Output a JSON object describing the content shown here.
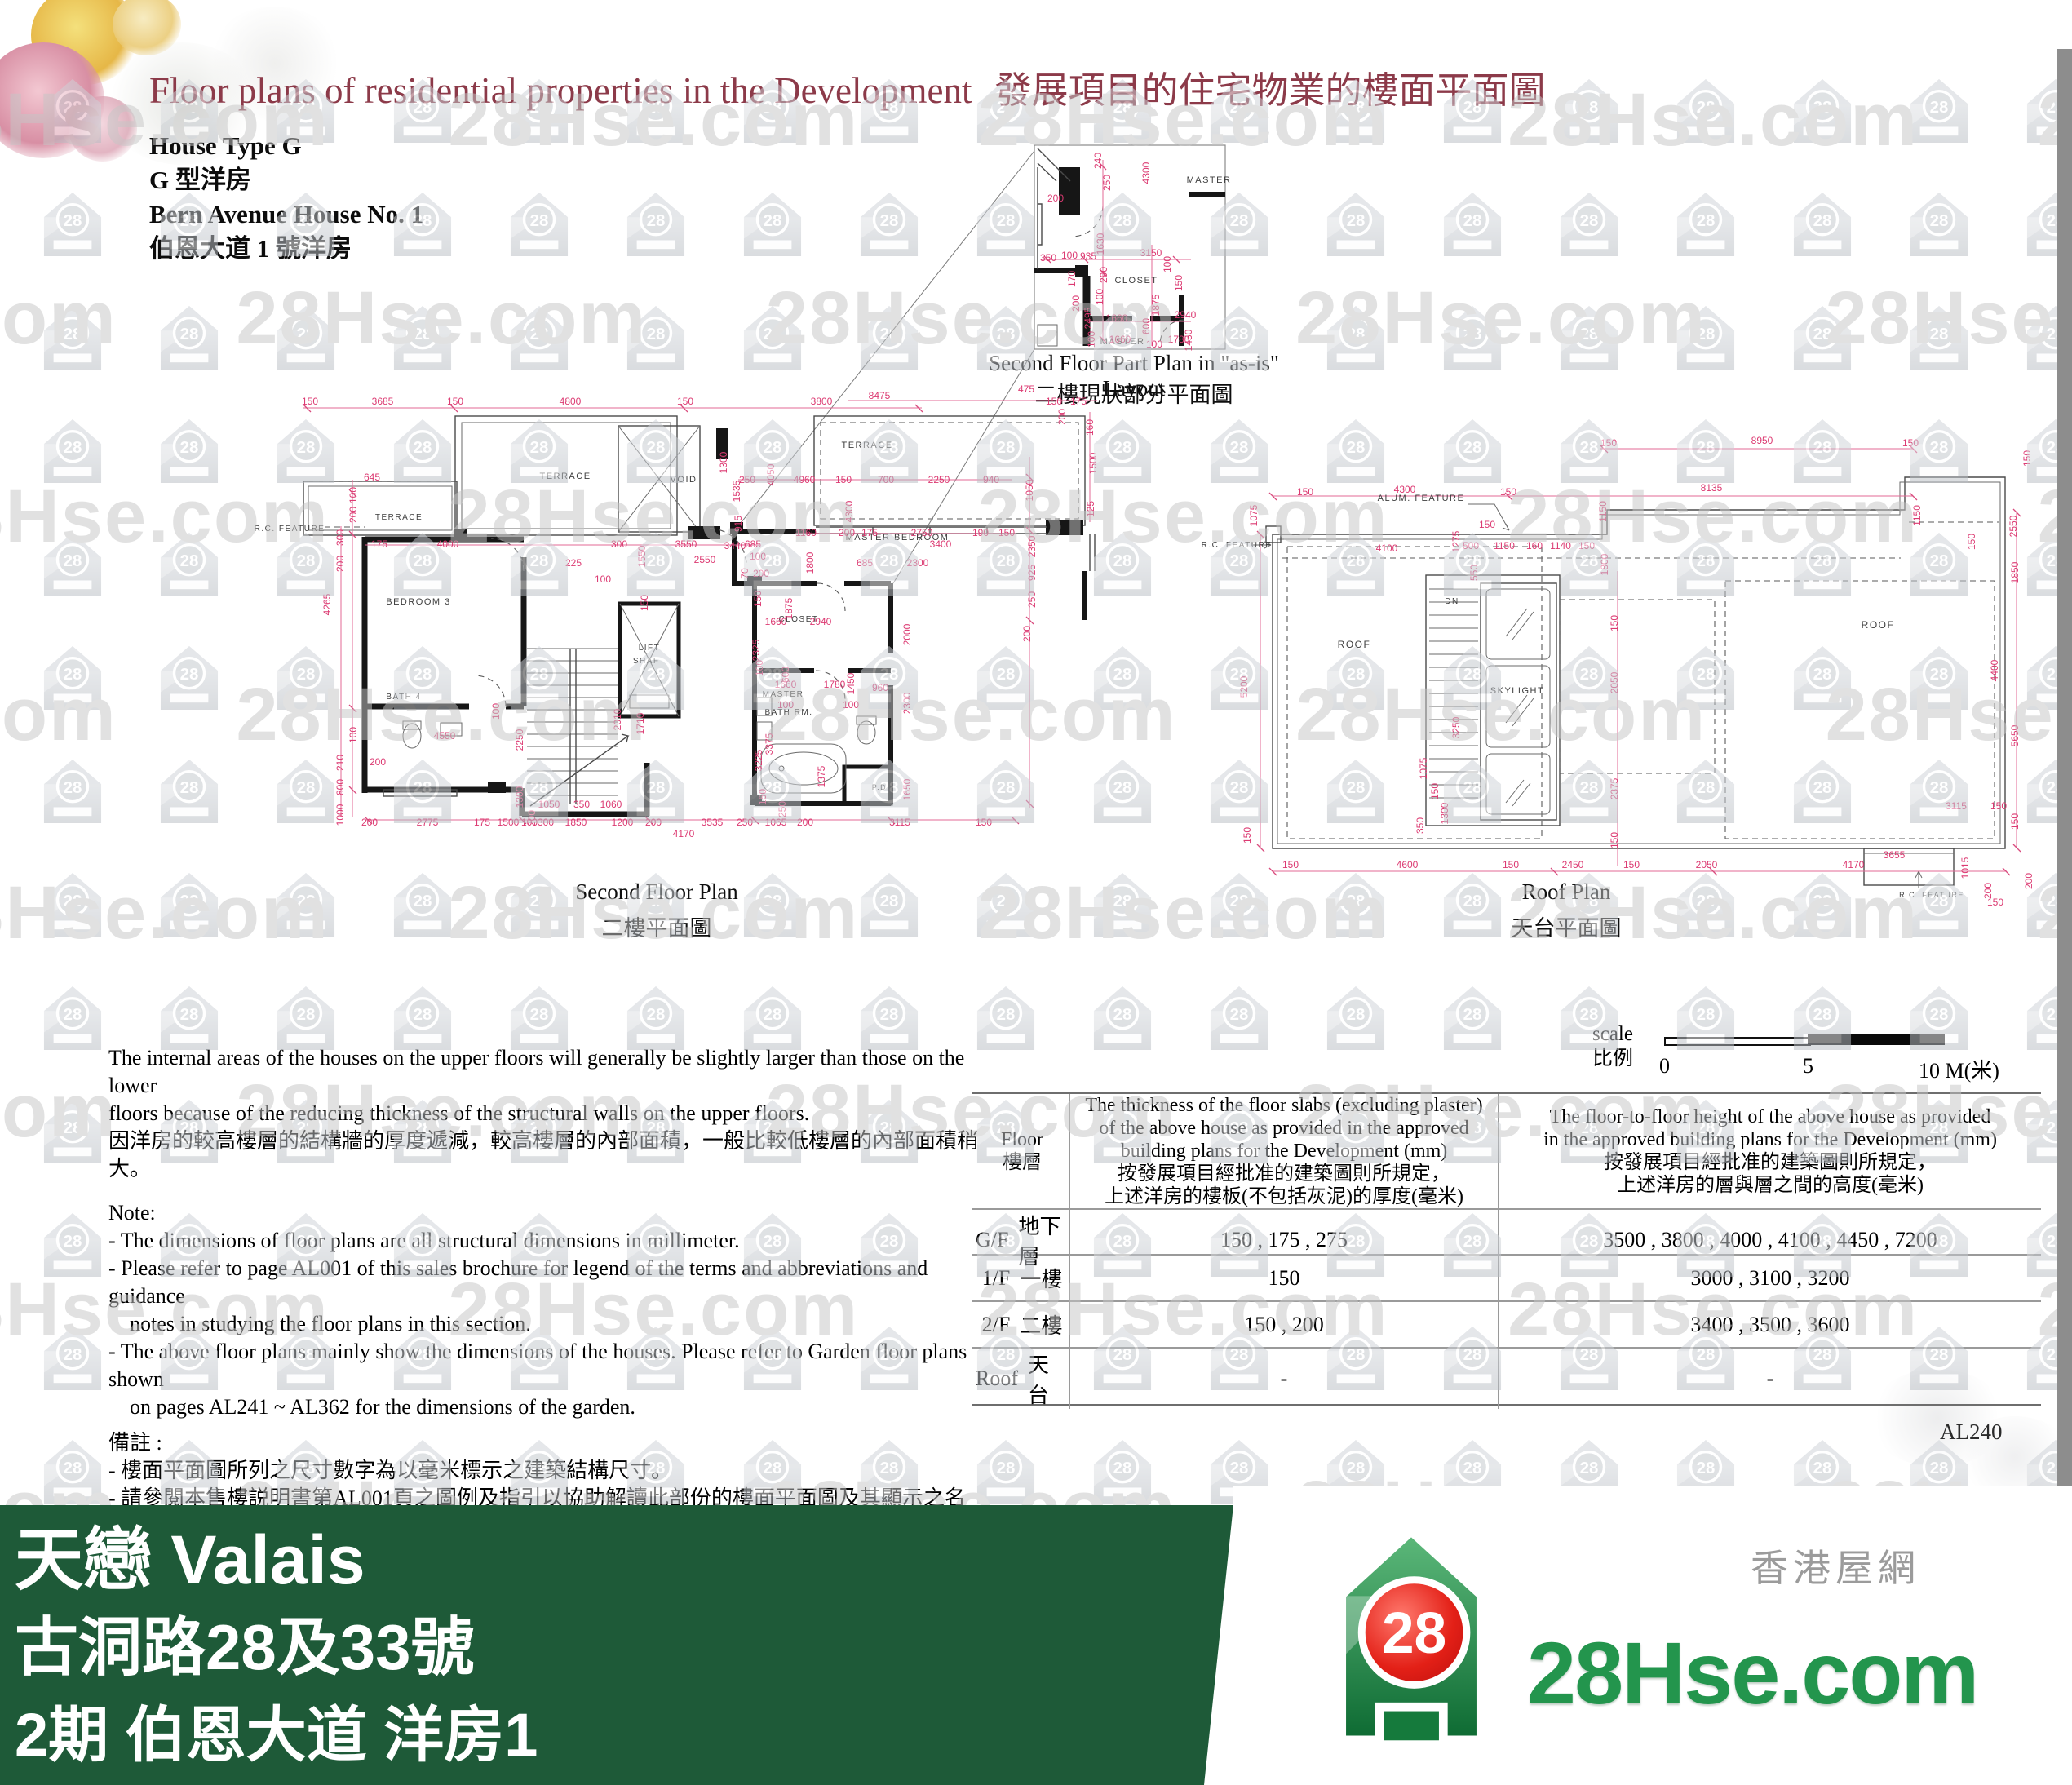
{
  "header": {
    "title_en": "Floor plans of residential properties in the Development",
    "title_zh": "發展項目的住宅物業的樓面平面圖",
    "house_type_en": "House Type G",
    "house_type_zh": "G 型洋房",
    "house_name_en": "Bern Avenue House No. 1",
    "house_name_zh": "伯恩大道 1 號洋房"
  },
  "watermark": {
    "text": "28Hse.com",
    "icon_label": "28"
  },
  "plans": {
    "inset": {
      "caption_en": "Second Floor Part Plan in \"as-is\" Layout",
      "caption_zh": "二樓現狀部分平面圖",
      "rooms": [
        [
          "MASTER",
          1482,
          224,
          11
        ],
        [
          "CLOSET",
          1393,
          347,
          11
        ],
        [
          "MASTER",
          1376,
          422,
          11
        ]
      ],
      "dims": [
        [
          "240",
          1350,
          197,
          1
        ],
        [
          "250",
          1361,
          224,
          1
        ],
        [
          "4300",
          1409,
          212,
          1
        ],
        [
          "200",
          1294,
          247
        ],
        [
          "350",
          1285,
          320
        ],
        [
          "100",
          1311,
          317
        ],
        [
          "935",
          1334,
          318
        ],
        [
          "1630",
          1353,
          299,
          1
        ],
        [
          "3150",
          1411,
          314
        ],
        [
          "100",
          1435,
          324,
          1
        ],
        [
          "150",
          1449,
          347,
          1
        ],
        [
          "170",
          1318,
          342,
          1
        ],
        [
          "290",
          1357,
          337,
          1
        ],
        [
          "100",
          1352,
          364,
          1
        ],
        [
          "200",
          1323,
          372,
          1
        ],
        [
          "2495",
          1338,
          390,
          1
        ],
        [
          "1660",
          1369,
          394
        ],
        [
          "1875",
          1421,
          374,
          1
        ],
        [
          "2940",
          1453,
          390
        ],
        [
          "100",
          1342,
          416,
          1
        ],
        [
          "600",
          1409,
          400,
          1
        ],
        [
          "1660",
          1373,
          420
        ],
        [
          "100",
          1415,
          426
        ],
        [
          "1780",
          1445,
          420
        ],
        [
          "1450",
          1461,
          417,
          1
        ]
      ]
    },
    "second": {
      "caption_en": "Second Floor Plan",
      "caption_zh": "二樓平面圖",
      "rooms": [
        [
          "TERRACE",
          489,
          637,
          10
        ],
        [
          "TERRACE",
          693,
          587,
          11
        ],
        [
          "VOID",
          838,
          591,
          11
        ],
        [
          "TERRACE",
          1063,
          549,
          11
        ],
        [
          "MASTER BEDROOM",
          1100,
          662,
          11
        ],
        [
          "R.C. FEATURE",
          355,
          651,
          10
        ],
        [
          "BEDROOM 3",
          513,
          741,
          11
        ],
        [
          "LIFT",
          796,
          797,
          10
        ],
        [
          "SHAFT",
          796,
          813,
          10
        ],
        [
          "BATH 4",
          495,
          857,
          10
        ],
        [
          "CLOSET",
          979,
          762,
          10
        ],
        [
          "MASTER",
          960,
          854,
          10
        ],
        [
          "BATH RM.",
          967,
          876,
          10
        ],
        [
          "P.D.",
          1080,
          968,
          9
        ]
      ],
      "dims": [
        [
          "150",
          380,
          496
        ],
        [
          "3685",
          469,
          496
        ],
        [
          "150",
          558,
          496
        ],
        [
          "4800",
          699,
          496
        ],
        [
          "150",
          840,
          496
        ],
        [
          "3800",
          1007,
          496
        ],
        [
          "8475",
          1078,
          489
        ],
        [
          "475",
          1258,
          481
        ],
        [
          "150",
          1292,
          496
        ],
        [
          "175",
          1322,
          496
        ],
        [
          "160",
          1340,
          524,
          1
        ],
        [
          "200",
          1306,
          511,
          1
        ],
        [
          "1500",
          1344,
          568,
          1
        ],
        [
          "125",
          1341,
          624,
          1
        ],
        [
          "1050",
          1266,
          601,
          1
        ],
        [
          "2350",
          1269,
          670,
          1
        ],
        [
          "925",
          1269,
          702,
          1
        ],
        [
          "250",
          1269,
          735,
          1
        ],
        [
          "200",
          1263,
          777,
          1
        ],
        [
          "2000",
          1116,
          778,
          1
        ],
        [
          "2300",
          1116,
          862,
          1
        ],
        [
          "1650",
          1116,
          968,
          1
        ],
        [
          "250",
          916,
          592
        ],
        [
          "4960",
          986,
          592
        ],
        [
          "150",
          1034,
          592
        ],
        [
          "700",
          1086,
          592
        ],
        [
          "2250",
          1151,
          592
        ],
        [
          "940",
          1215,
          592
        ],
        [
          "4050",
          949,
          582,
          1
        ],
        [
          "1535",
          907,
          602,
          1
        ],
        [
          "915",
          909,
          642,
          1
        ],
        [
          "1300",
          891,
          567,
          1
        ],
        [
          "4300",
          1045,
          627,
          1
        ],
        [
          "645",
          456,
          589
        ],
        [
          "100",
          437,
          607,
          1
        ],
        [
          "200",
          437,
          631,
          1
        ],
        [
          "300",
          421,
          659,
          1
        ],
        [
          "200",
          421,
          691,
          1
        ],
        [
          "4265",
          405,
          741,
          1
        ],
        [
          "100",
          437,
          901,
          1
        ],
        [
          "210",
          421,
          935,
          1
        ],
        [
          "800",
          421,
          965,
          1
        ],
        [
          "1000",
          421,
          999,
          1
        ],
        [
          "175",
          465,
          671
        ],
        [
          "4000",
          549,
          671
        ],
        [
          "300",
          759,
          671
        ],
        [
          "3550",
          841,
          671
        ],
        [
          "685",
          923,
          671
        ],
        [
          "3400",
          1153,
          671
        ],
        [
          "1160",
          988,
          657
        ],
        [
          "200",
          1038,
          657
        ],
        [
          "175",
          1066,
          657
        ],
        [
          "2750",
          1130,
          657
        ],
        [
          "190",
          1202,
          657
        ],
        [
          "150",
          1234,
          657
        ],
        [
          "225",
          703,
          694
        ],
        [
          "100",
          739,
          714
        ],
        [
          "1550",
          791,
          682,
          1
        ],
        [
          "150",
          794,
          739,
          1
        ],
        [
          "2550",
          864,
          690
        ],
        [
          "200",
          933,
          707
        ],
        [
          "1800",
          997,
          690,
          1
        ],
        [
          "685",
          1060,
          694
        ],
        [
          "2300",
          1125,
          694
        ],
        [
          "4550",
          545,
          906
        ],
        [
          "200",
          463,
          938
        ],
        [
          "100",
          612,
          872,
          1
        ],
        [
          "2010",
          761,
          882,
          1
        ],
        [
          "1710",
          789,
          887,
          1
        ],
        [
          "2250",
          641,
          907,
          1
        ],
        [
          "1300",
          641,
          977,
          1
        ],
        [
          "200",
          656,
          1003,
          1
        ],
        [
          "1050",
          673,
          990
        ],
        [
          "350",
          713,
          990
        ],
        [
          "1060",
          749,
          990
        ],
        [
          "3440",
          901,
          673
        ],
        [
          "100",
          929,
          686
        ],
        [
          "70",
          917,
          703,
          1
        ],
        [
          "150",
          933,
          734,
          1
        ],
        [
          "1875",
          971,
          746,
          1
        ],
        [
          "1660",
          951,
          766
        ],
        [
          "2940",
          1006,
          766
        ],
        [
          "2325",
          931,
          797,
          1
        ],
        [
          "100",
          935,
          819,
          1
        ],
        [
          "600",
          967,
          827,
          1
        ],
        [
          "1660",
          963,
          843
        ],
        [
          "1780",
          1023,
          843
        ],
        [
          "1450",
          1047,
          838,
          1
        ],
        [
          "960",
          1079,
          847
        ],
        [
          "100",
          963,
          868
        ],
        [
          "100",
          1043,
          868
        ],
        [
          "3375",
          947,
          912,
          1
        ],
        [
          "3225",
          934,
          932,
          1
        ],
        [
          "1375",
          1011,
          952,
          1
        ],
        [
          "150",
          939,
          977,
          1
        ],
        [
          "250",
          963,
          992,
          1
        ],
        [
          "200",
          453,
          1012
        ],
        [
          "2775",
          524,
          1012
        ],
        [
          "175",
          591,
          1012
        ],
        [
          "1500",
          623,
          1012
        ],
        [
          "100",
          649,
          1012
        ],
        [
          "300",
          669,
          1012
        ],
        [
          "1850",
          706,
          1012
        ],
        [
          "1200",
          763,
          1012
        ],
        [
          "200",
          801,
          1012
        ],
        [
          "3535",
          873,
          1012
        ],
        [
          "250",
          913,
          1012
        ],
        [
          "1065",
          951,
          1012
        ],
        [
          "200",
          987,
          1012
        ],
        [
          "3115",
          1103,
          1012
        ],
        [
          "150",
          1206,
          1012
        ],
        [
          "4170",
          838,
          1026
        ]
      ]
    },
    "roof": {
      "caption_en": "Roof Plan",
      "caption_zh": "天台平面圖",
      "rooms": [
        [
          "ALUM. FEATURE",
          1742,
          614,
          11
        ],
        [
          "R.C. FEATURE",
          1516,
          671,
          10
        ],
        [
          "ROOF",
          1660,
          794,
          12
        ],
        [
          "DN",
          1780,
          740,
          10
        ],
        [
          "SKYLIGHT",
          1860,
          850,
          11
        ],
        [
          "ROOF",
          2302,
          770,
          12
        ],
        [
          "R.C. FEATURE",
          2368,
          1100,
          9
        ]
      ],
      "dims": [
        [
          "150",
          1972,
          547
        ],
        [
          "8950",
          2160,
          544
        ],
        [
          "150",
          2342,
          547
        ],
        [
          "150",
          1600,
          607
        ],
        [
          "4300",
          1722,
          604
        ],
        [
          "150",
          1849,
          607
        ],
        [
          "8135",
          2098,
          602
        ],
        [
          "1150",
          2354,
          632,
          1
        ],
        [
          "2550",
          2472,
          645,
          1
        ],
        [
          "150",
          2489,
          562,
          1
        ],
        [
          "1075",
          1541,
          632,
          1
        ],
        [
          "5200",
          1529,
          842,
          1
        ],
        [
          "150",
          1533,
          1024,
          1
        ],
        [
          "4100",
          1700,
          676
        ],
        [
          "1275",
          1789,
          664,
          1
        ],
        [
          "550",
          1811,
          702,
          1
        ],
        [
          "150",
          1823,
          647
        ],
        [
          "500",
          1803,
          673
        ],
        [
          "1150",
          1844,
          673
        ],
        [
          "160",
          1881,
          673
        ],
        [
          "1140",
          1913,
          673
        ],
        [
          "150",
          1945,
          673
        ],
        [
          "1800",
          1971,
          692,
          1
        ],
        [
          "1150",
          1969,
          627,
          1
        ],
        [
          "150",
          2421,
          664,
          1
        ],
        [
          "4400",
          2449,
          822,
          1
        ],
        [
          "1850",
          2474,
          702,
          1
        ],
        [
          "5650",
          2474,
          902,
          1
        ],
        [
          "150",
          2474,
          1007,
          1
        ],
        [
          "200",
          2491,
          1080,
          1
        ],
        [
          "150",
          2446,
          1110
        ],
        [
          "3250",
          1789,
          892,
          1
        ],
        [
          "2050",
          1983,
          837,
          1
        ],
        [
          "150",
          1983,
          764,
          1
        ],
        [
          "2375",
          1983,
          967,
          1
        ],
        [
          "150",
          1983,
          1030,
          1
        ],
        [
          "1075",
          1749,
          942,
          1
        ],
        [
          "150",
          1763,
          970,
          1
        ],
        [
          "1300",
          1775,
          997,
          1
        ],
        [
          "350",
          1745,
          1012,
          1
        ],
        [
          "150",
          1582,
          1064
        ],
        [
          "4600",
          1725,
          1064
        ],
        [
          "150",
          1852,
          1064
        ],
        [
          "2450",
          1928,
          1064
        ],
        [
          "150",
          2000,
          1064
        ],
        [
          "2050",
          2092,
          1064
        ],
        [
          "4170",
          2272,
          1064
        ],
        [
          "3655",
          2322,
          1052
        ],
        [
          "1015",
          2413,
          1064,
          1
        ],
        [
          "200",
          2441,
          1092,
          1
        ],
        [
          "3115",
          2398,
          992
        ],
        [
          "150",
          2450,
          992
        ]
      ]
    }
  },
  "notes": {
    "en1": "The internal areas of the houses on the upper floors will generally be slightly larger than those on the lower",
    "en2": "floors because of the reducing thickness of the structural walls on the upper floors.",
    "zh": "因洋房的較高樓層的結構牆的厚度遞減，較高樓層的內部面積，一般比較低樓層的內部面積稍大。",
    "note_label": "Note:",
    "n1": "- The dimensions of floor plans are all structural dimensions in millimeter.",
    "n2a": "- Please refer to page AL001 of this sales brochure for legend of the terms and abbreviations and guidance",
    "n2b": "notes in studying the floor plans in this section.",
    "n3a": "- The above floor plans mainly show the dimensions of the houses. Please refer to Garden floor plans shown",
    "n3b": "on pages AL241 ~ AL362 for the dimensions of the garden.",
    "zh_label": "備註 :",
    "zn1": "- 樓面平面圖所列之尺寸數字為以毫米標示之建築結構尺寸。",
    "zn2": "- 請參閱本售樓説明書第AL001頁之圖例及指引以協助解讀此部份的樓面平面圖及其顯示之名稱及簡稱。",
    "zn3": "- 以上樓面平面圖主要顯示洋房的呎吋，有關花園的呎吋，請參閱第AL241頁至AL362頁的花園平面圖。"
  },
  "scale": {
    "label_en": "scale",
    "label_zh": "比例",
    "tick0": "0",
    "tick5": "5",
    "tick10": "10 M(米)"
  },
  "table": {
    "col1_en": "Floor",
    "col1_zh": "樓層",
    "col2_en1": "The thickness of the floor slabs (excluding plaster)",
    "col2_en2": "of the above house as provided in the approved",
    "col2_en3": "building plans for the Development (mm)",
    "col2_zh1": "按發展項目經批准的建築圖則所規定，",
    "col2_zh2": "上述洋房的樓板(不包括灰泥)的厚度(毫米)",
    "col3_en1": "The floor-to-floor height of the above house as provided",
    "col3_en2": "in the approved building plans for the Development (mm)",
    "col3_zh1": "按發展項目經批准的建築圖則所規定，",
    "col3_zh2": "上述洋房的層與層之間的高度(毫米)",
    "rows": [
      {
        "floor_en": "G/F",
        "floor_zh": "地下層",
        "thickness": "150 , 175 , 275",
        "height": "3500 , 3800 , 4000 , 4100 , 4450 , 7200"
      },
      {
        "floor_en": "1/F",
        "floor_zh": "一樓",
        "thickness": "150",
        "height": "3000 , 3100 , 3200"
      },
      {
        "floor_en": "2/F",
        "floor_zh": "二樓",
        "thickness": "150 , 200",
        "height": "3400 , 3500 , 3600"
      },
      {
        "floor_en": "Roof",
        "floor_zh": "天台",
        "thickness": "-",
        "height": "-"
      }
    ]
  },
  "page_number": "AL240",
  "banner": {
    "line1": "天戀 Valais",
    "line2": "古洞路28及33號",
    "line3": "2期 伯恩大道 洋房1"
  },
  "logo": {
    "site": "28Hse.com",
    "tagline": "香港屋網",
    "icon_number": "28"
  }
}
